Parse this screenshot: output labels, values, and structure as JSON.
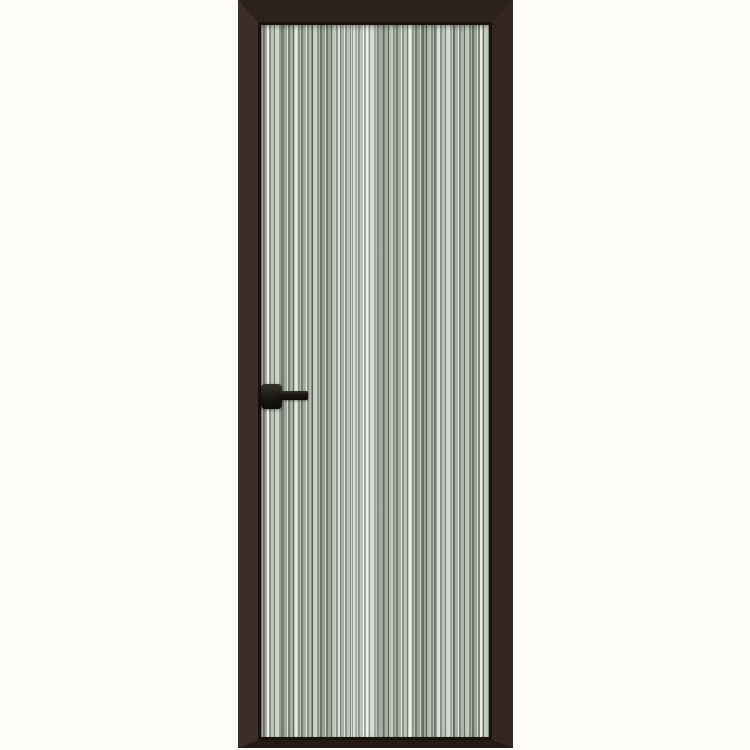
{
  "scene": {
    "description": "Product photo of a tall narrow interior door with a dark brown aluminum frame and a fluted vertical-striped glass panel on a plain off-white background",
    "subject": "aluminum-frame fluted glass door",
    "door": {
      "frame_material": "dark brown aluminum profile",
      "panel": "vertical fluted striped glass",
      "handle": {
        "type": "lever handle with square backplate",
        "side": "left",
        "orientation": "pointing right"
      }
    },
    "colors": {
      "background": "#fdfcf8",
      "frame_top": "#2c211c",
      "frame_left": "#3b2d28",
      "frame_right": "#332622",
      "frame_bottom": "#241a16",
      "inner_line": "#1b110d",
      "glass_base": "#a9b2a7",
      "stripe_light": "#e9efe6",
      "stripe_mid": "#9aa398",
      "stripe_dark": "#5c635a",
      "handle": "#1c1714"
    }
  }
}
